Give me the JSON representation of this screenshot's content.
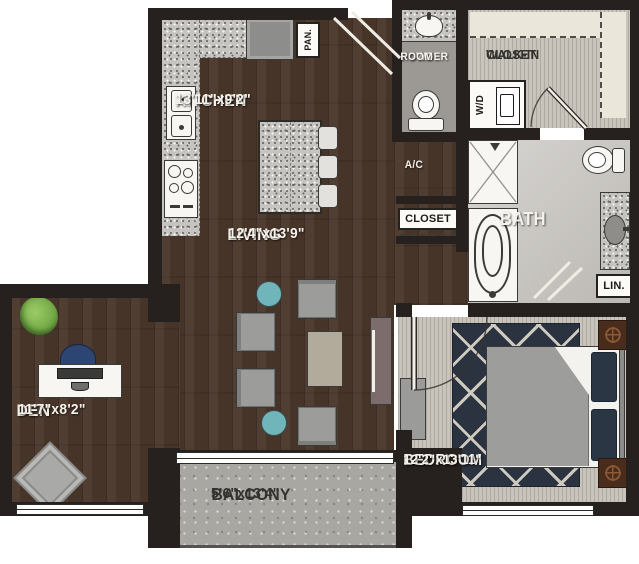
{
  "title": "One-bedroom apartment floor plan with den",
  "colors": {
    "wall": "#26211e",
    "wood": "#473428",
    "carpet": "#c8c3bb",
    "tile": "#cac7c2",
    "powder_floor": "#9c9995",
    "granite": "#c6c4c0",
    "concrete": "#a8a7a2",
    "shelf": "#eae6d9",
    "rug_navy": "#2b3240",
    "rug_line": "#cfcac0",
    "teal": "#6fb5ba",
    "chair_gray": "#9c9c9a",
    "chair_navy": "#2c4573",
    "console": "#7c6c6c",
    "coffee": "#b2aa9b",
    "bed_blanket": "#9d9d9b",
    "pillow_navy": "#2b3645",
    "nightstand": "#4a2c1c",
    "plant": "#76ad49",
    "label_white": "#f5f2ec",
    "label_dark": "#33322f"
  },
  "rooms": {
    "kitchen": {
      "name": "KITCHEN",
      "dims": "13'11\"x9'2\""
    },
    "living": {
      "name": "LIVING",
      "dims": "12'4\"x13'9\""
    },
    "den": {
      "name": "DEN",
      "dims": "11'7\"x8'2\""
    },
    "bedroom": {
      "name": "BEDROOM",
      "dims": "12'2\"x13'11\""
    },
    "balcony": {
      "name": "BALCONY",
      "dims": "5'6\"x13'4\""
    },
    "bath": {
      "name": "BATH"
    },
    "powder": {
      "line1": "POWDER",
      "line2": "ROOM"
    },
    "walkin": {
      "line1": "WALK-IN",
      "line2": "CLOSET"
    },
    "ac": {
      "name": "A/C"
    },
    "closet": {
      "name": "CLOSET"
    },
    "pantry": {
      "name": "PAN."
    },
    "linen": {
      "name": "LIN."
    },
    "washer_dryer": {
      "name": "W/D"
    }
  }
}
